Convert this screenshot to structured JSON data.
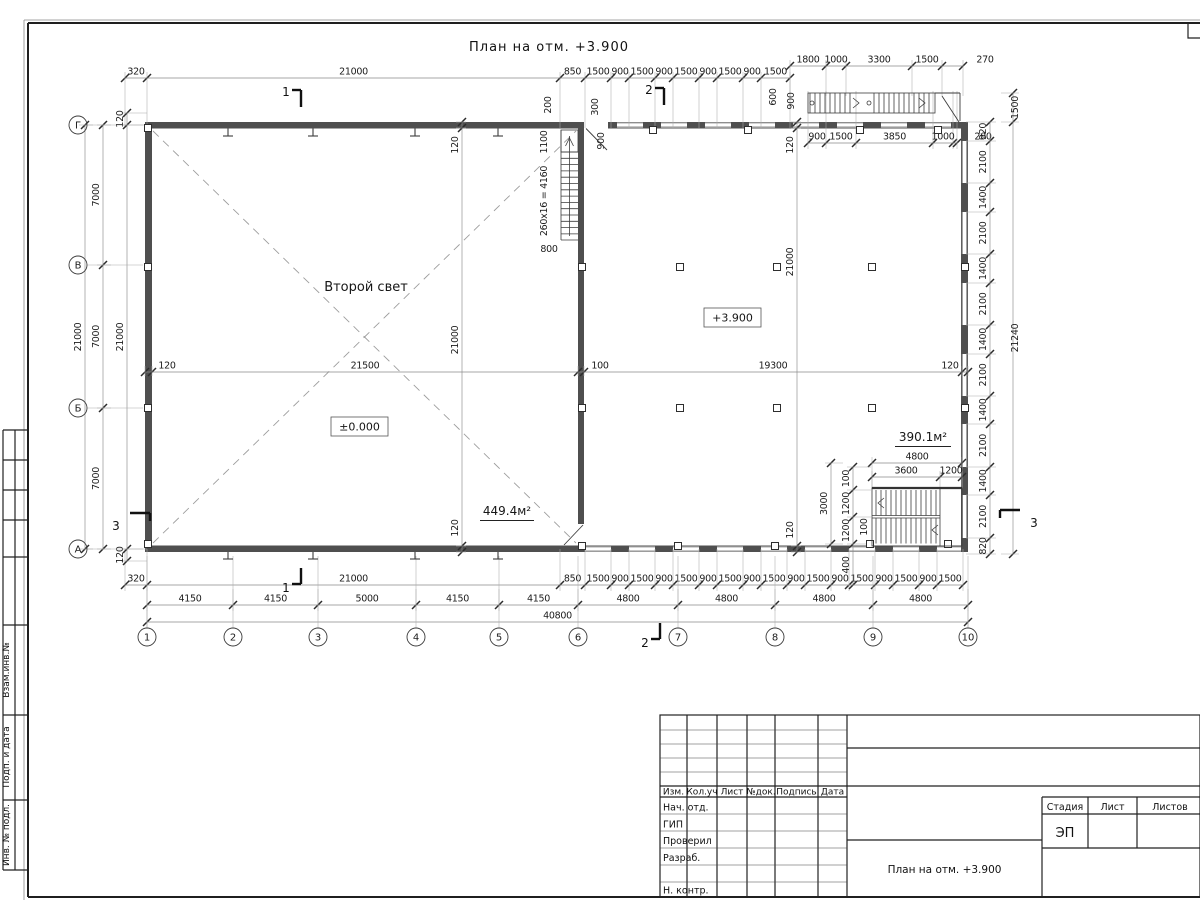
{
  "sheet": {
    "plan_title": "План на отм. +3.900",
    "side_stamp": {
      "labels": [
        "Взам.инв.№",
        "Подп. и дата",
        "Инв. № подл."
      ]
    },
    "title_block": {
      "rev_columns": [
        "Изм.",
        "Кол.уч",
        "Лист",
        "№док.",
        "Подпись",
        "Дата"
      ],
      "staff_rows": [
        "Нач. отд.",
        "ГИП",
        "Проверил",
        "Разраб.",
        "",
        "Н. контр."
      ],
      "stage_label": "Стадия",
      "sheet_label": "Лист",
      "sheets_label": "Листов",
      "stage_value": "ЭП",
      "doc_title": "План на отм. +3.900"
    }
  },
  "plan": {
    "room_labels": {
      "second_light": "Второй свет",
      "elev_zero": "±0.000",
      "elev_390": "+3.900",
      "area_left": "449.4м²",
      "area_right": "390.1м²"
    },
    "colors": {
      "ink": "#1c1c1c",
      "wall": "#4f4f4f"
    },
    "axes": {
      "cols": [
        {
          "n": "1",
          "x": 147
        },
        {
          "n": "2",
          "x": 233
        },
        {
          "n": "3",
          "x": 318
        },
        {
          "n": "4",
          "x": 416
        },
        {
          "n": "5",
          "x": 499
        },
        {
          "n": "6",
          "x": 578
        },
        {
          "n": "7",
          "x": 678
        },
        {
          "n": "8",
          "x": 775
        },
        {
          "n": "9",
          "x": 873
        },
        {
          "n": "10",
          "x": 968
        }
      ],
      "rows": [
        {
          "n": "Г",
          "y": 125
        },
        {
          "n": "В",
          "y": 265
        },
        {
          "n": "Б",
          "y": 408
        },
        {
          "n": "А",
          "y": 549
        }
      ]
    },
    "dim_lines": [
      {
        "name": "dim-top-main",
        "dir": "h",
        "pos": 78,
        "ext": 50,
        "b": [
          125,
          147,
          560,
          585,
          611,
          629,
          655,
          673,
          699,
          717,
          743,
          761,
          790
        ],
        "labels": [
          "320",
          "21000",
          "850",
          "1500",
          "900",
          "1500",
          "900",
          "1500",
          "900",
          "1500",
          "900",
          "1500"
        ]
      },
      {
        "name": "dim-top-right",
        "dir": "h",
        "pos": 66,
        "ext": 30,
        "b": [
          790,
          826,
          846,
          912,
          942,
          963
        ],
        "labels": [
          "1800",
          "1000",
          "3300",
          "1500",
          "270"
        ],
        "lp": {
          "4": 985
        }
      },
      {
        "name": "dim-under-ext-stair",
        "dir": "h",
        "pos": 143,
        "ext": -52,
        "b": [
          808,
          826,
          856,
          933,
          953,
          957
        ],
        "labels": [
          "900",
          "1500",
          "3850",
          "1000",
          "200"
        ],
        "lp": {
          "4": 983
        }
      },
      {
        "name": "dim-mid",
        "dir": "h",
        "pos": 372,
        "ext": 4,
        "b": [
          145,
          152,
          578,
          584,
          962,
          968
        ],
        "labels": [
          "120",
          "21500",
          "100",
          "19300",
          "120"
        ],
        "lp": {
          "0": 167,
          "2": 600,
          "4": 950
        }
      },
      {
        "name": "dim-bottom-1",
        "dir": "h",
        "pos": 585,
        "ext": -36,
        "b": [
          125,
          147,
          560,
          585,
          611,
          629,
          655,
          673,
          699,
          717,
          743,
          761,
          787,
          805,
          831,
          849,
          875,
          893,
          919,
          937,
          963
        ],
        "labels": [
          "320",
          "21000",
          "850",
          "1500",
          "900",
          "1500",
          "900",
          "1500",
          "900",
          "1500",
          "900",
          "1500",
          "900",
          "1500",
          "900",
          "1500",
          "900",
          "1500",
          "900",
          "1500"
        ]
      },
      {
        "name": "dim-bottom-2",
        "dir": "h",
        "pos": 605,
        "ext": -16,
        "b": [
          147,
          233,
          318,
          416,
          499,
          578,
          678,
          775,
          873,
          968
        ],
        "labels": [
          "4150",
          "4150",
          "5000",
          "4150",
          "4150",
          "4800",
          "4800",
          "4800",
          "4800"
        ]
      },
      {
        "name": "dim-bottom-3",
        "dir": "h",
        "pos": 622,
        "ext": -12,
        "b": [
          147,
          968
        ],
        "labels": [
          "40800"
        ]
      },
      {
        "name": "dim-stair-4800",
        "dir": "h",
        "pos": 463,
        "ext": 26,
        "b": [
          872,
          962
        ],
        "labels": [
          "4800"
        ]
      },
      {
        "name": "dim-stair-3600",
        "dir": "h",
        "pos": 477,
        "ext": 12,
        "b": [
          872,
          940,
          962
        ],
        "labels": [
          "3600",
          "1200"
        ]
      },
      {
        "name": "dim-left-21000",
        "dir": "v",
        "pos": 85,
        "ext": 8,
        "b": [
          125,
          549
        ],
        "labels": [
          "21000"
        ]
      },
      {
        "name": "dim-left-7000",
        "dir": "v",
        "pos": 103,
        "ext": 8,
        "b": [
          125,
          265,
          408,
          549
        ],
        "labels": [
          "7000",
          "7000",
          "7000"
        ]
      },
      {
        "name": "dim-left-inner",
        "dir": "v",
        "pos": 127,
        "ext": 20,
        "b": [
          113,
          125,
          549,
          561
        ],
        "labels": [
          "120",
          "21000",
          "120"
        ]
      },
      {
        "name": "dim-right-inner",
        "dir": "v",
        "pos": 990,
        "ext": -24,
        "b": [
          122,
          141,
          183,
          212,
          254,
          283,
          325,
          354,
          396,
          424,
          467,
          495,
          538,
          554
        ],
        "labels": [
          "920",
          "2100",
          "1400",
          "2100",
          "1400",
          "2100",
          "1400",
          "2100",
          "1400",
          "2100",
          "1400",
          "2100",
          "820"
        ]
      },
      {
        "name": "dim-right-outer",
        "dir": "v",
        "pos": 1013,
        "ext": -12,
        "lo": 5,
        "b": [
          93,
          122,
          554
        ],
        "labels": [
          "1500",
          "21240"
        ]
      },
      {
        "name": "dim-hall-left",
        "dir": "v",
        "pos": 462,
        "ext": 4,
        "b": [
          122,
          128,
          546,
          552
        ],
        "labels": [
          "120",
          "21000",
          "120"
        ],
        "lp": {
          "0": 145,
          "1": 340,
          "2": 528
        }
      },
      {
        "name": "dim-hall-right",
        "dir": "v",
        "pos": 797,
        "ext": 4,
        "b": [
          122,
          128,
          546,
          552
        ],
        "labels": [
          "120",
          "21000",
          "120"
        ],
        "lp": {
          "0": 145,
          "1": 262,
          "2": 530
        }
      },
      {
        "name": "dim-stairbr-inner",
        "dir": "v",
        "pos": 853,
        "ext": 18,
        "b": [
          467,
          490,
          517,
          544,
          585
        ],
        "labels": [
          "100",
          "1200",
          "1200",
          "400"
        ],
        "lp": {
          "3": 565
        }
      },
      {
        "name": "dim-stairbr-outer",
        "dir": "v",
        "pos": 831,
        "ext": 12,
        "b": [
          463,
          544
        ],
        "labels": [
          "3000"
        ]
      }
    ],
    "free_labels": [
      {
        "t": "200",
        "x": 551,
        "y": 105,
        "r": -90
      },
      {
        "t": "300",
        "x": 598,
        "y": 107,
        "r": -90
      },
      {
        "t": "1100",
        "x": 547,
        "y": 142,
        "r": -90
      },
      {
        "t": "260x16 = 4160",
        "x": 547,
        "y": 201,
        "r": -90
      },
      {
        "t": "800",
        "x": 549,
        "y": 252,
        "r": 0
      },
      {
        "t": "900",
        "x": 604,
        "y": 141,
        "r": -90
      },
      {
        "t": "600",
        "x": 776,
        "y": 97,
        "r": -90
      },
      {
        "t": "900",
        "x": 794,
        "y": 101,
        "r": -90
      },
      {
        "t": "100",
        "x": 867,
        "y": 527,
        "r": -90
      }
    ],
    "section_marks": [
      {
        "n": "1",
        "x": 286,
        "y": 96,
        "o": "t"
      },
      {
        "n": "1",
        "x": 286,
        "y": 592,
        "o": "b"
      },
      {
        "n": "2",
        "x": 649,
        "y": 94,
        "o": "t"
      },
      {
        "n": "2",
        "x": 645,
        "y": 647,
        "o": "b"
      },
      {
        "n": "3",
        "x": 116,
        "y": 530,
        "o": "lt"
      },
      {
        "n": "3",
        "x": 1034,
        "y": 527,
        "o": "rt"
      }
    ],
    "squares": [
      [
        148,
        128
      ],
      [
        148,
        267
      ],
      [
        148,
        408
      ],
      [
        148,
        544
      ],
      [
        582,
        267
      ],
      [
        582,
        408
      ],
      [
        582,
        546
      ],
      [
        653,
        130
      ],
      [
        748,
        130
      ],
      [
        860,
        130
      ],
      [
        938,
        130
      ],
      [
        680,
        267
      ],
      [
        777,
        267
      ],
      [
        872,
        267
      ],
      [
        680,
        408
      ],
      [
        777,
        408
      ],
      [
        872,
        408
      ],
      [
        678,
        546
      ],
      [
        775,
        546
      ],
      [
        965,
        267
      ],
      [
        965,
        408
      ],
      [
        870,
        544
      ],
      [
        948,
        544
      ]
    ],
    "ibeams": {
      "top": {
        "xs": [
          228,
          313,
          415,
          498
        ]
      },
      "bottom": {
        "xs": [
          228,
          313,
          415,
          498
        ]
      }
    },
    "windows": {
      "right": [
        [
          141,
          183
        ],
        [
          212,
          254
        ],
        [
          283,
          325
        ],
        [
          354,
          396
        ],
        [
          424,
          467
        ],
        [
          495,
          538
        ]
      ],
      "top": [
        [
          617,
          643
        ],
        [
          661,
          687
        ],
        [
          705,
          731
        ],
        [
          749,
          775
        ],
        [
          793,
          819
        ],
        [
          837,
          863
        ],
        [
          881,
          907
        ],
        [
          925,
          951
        ]
      ],
      "bottom": [
        [
          585,
          611
        ],
        [
          629,
          655
        ],
        [
          673,
          699
        ],
        [
          717,
          743
        ],
        [
          761,
          787
        ],
        [
          805,
          831
        ],
        [
          849,
          875
        ],
        [
          893,
          919
        ],
        [
          937,
          961
        ]
      ]
    },
    "stairs": {
      "center": {
        "x1": 561,
        "x2": 578,
        "y1": 152,
        "y2": 240,
        "step": 6.3
      },
      "external": {
        "y1": 93,
        "y2": 113,
        "flight1": [
          810,
          850
        ],
        "flight2": [
          874,
          932
        ],
        "step": 5,
        "posts": [
          [
            812,
            103
          ],
          [
            869,
            103
          ]
        ],
        "chevrons": [
          [
            857,
            103
          ],
          [
            923,
            103
          ]
        ]
      },
      "bottom_right": {
        "x1": 876,
        "x2": 938,
        "b1": [
          490,
          515.5
        ],
        "b2": [
          518,
          543.5
        ],
        "step": 5,
        "chevrons": [
          [
            880,
            503
          ],
          [
            934,
            530
          ]
        ]
      }
    }
  }
}
